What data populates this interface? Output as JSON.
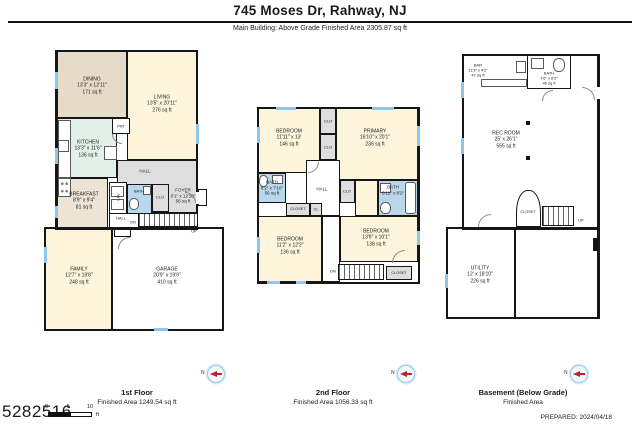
{
  "header": {
    "title": "745 Moses Dr, Rahway, NJ",
    "subtitle": "Main Building: Above Grade Finished Area 2305.87 sq ft"
  },
  "floors": {
    "first": {
      "caption": "1st Floor",
      "area_caption": "Finished Area 1249.54 sq ft",
      "rooms": {
        "dining": {
          "name": "DINING",
          "dims": "13'3\" x 12'11\"",
          "area": "171 sq ft"
        },
        "living": {
          "name": "LIVING",
          "dims": "13'5\" x 20'11\"",
          "area": "276 sq ft"
        },
        "kitchen": {
          "name": "KITCHEN",
          "dims": "13'3\" x 11'6\"",
          "area": "136 sq ft"
        },
        "breakfast": {
          "name": "BREAKFAST",
          "dims": "8'9\" x 9'4\"",
          "area": "81 sq ft"
        },
        "foyer": {
          "name": "FOYER",
          "dims": "6'1\" x 12'10\"",
          "area": "56 sq ft"
        },
        "family": {
          "name": "FAMILY",
          "dims": "12'7\" x 19'8\"",
          "area": "248 sq ft"
        },
        "garage": {
          "name": "GARAGE",
          "dims": "20'9\" x 19'9\"",
          "area": "410 sq ft"
        }
      },
      "tags": {
        "hall_upper": "HALL",
        "hall_lower": "HALL",
        "lav": "LAV",
        "bath": "BATH",
        "clo": "CLO",
        "pnt": "PNT",
        "dn": "DN",
        "up": "UP"
      }
    },
    "second": {
      "caption": "2nd Floor",
      "area_caption": "Finished Area 1056.33 sq ft",
      "rooms": {
        "bedroom1": {
          "name": "BEDROOM",
          "dims": "11'11\" x 13'",
          "area": "146 sq ft"
        },
        "primary": {
          "name": "PRIMARY",
          "dims": "16'10\" x 20'1\"",
          "area": "236 sq ft"
        },
        "bath1": {
          "name": "BATH",
          "dims": "8'2\" x 7'10\"",
          "area": "56 sq ft"
        },
        "bath2": {
          "name": "BATH",
          "dims": "6'11\" x 8'2\""
        },
        "bedroom2": {
          "name": "BEDROOM",
          "dims": "11'2\" x 12'2\"",
          "area": "136 sq ft"
        },
        "bedroom3": {
          "name": "BEDROOM",
          "dims": "13'9\" x 10'1\"",
          "area": "138 sq ft"
        }
      },
      "tags": {
        "clo_a": "CLO",
        "clo_b": "CLO",
        "clo_c": "CLO",
        "closet_a": "CLOSET",
        "cl": "CL",
        "closet_b": "CLOSET",
        "hall": "HALL",
        "dn": "DN"
      }
    },
    "basement": {
      "caption": "Basement (Below Grade)",
      "area_caption": "Finished Area",
      "rooms": {
        "rec": {
          "name": "REC ROOM",
          "dims": "25' x 26'1\"",
          "area": "555 sq ft"
        },
        "bath": {
          "name": "BATH",
          "dims": "7'6\" x 6'2\"",
          "area": "46 sq ft"
        },
        "bar": {
          "name": "BAR",
          "dims": "11'3\" x 4'2\"",
          "area": "47 sq ft"
        },
        "utility": {
          "name": "UTILITY",
          "dims": "12' x 18'10\"",
          "area": "226 sq ft"
        }
      },
      "tags": {
        "closet": "CLOSET",
        "up": "UP"
      }
    }
  },
  "footer": {
    "plan_id": "5282516",
    "compass_letter": "N",
    "scale": {
      "zero": "0",
      "five": "5",
      "ten": "10",
      "unit": "ft"
    },
    "prepared": "PREPARED: 2024/04/18"
  }
}
